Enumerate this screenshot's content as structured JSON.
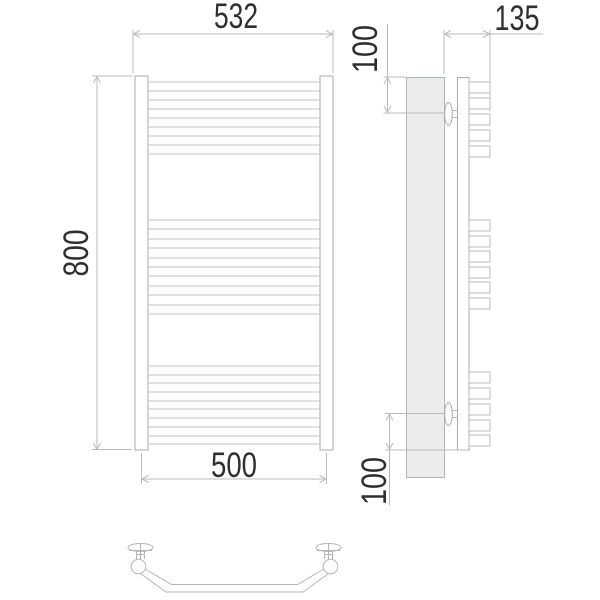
{
  "drawing": {
    "front_view": {
      "overall_width": "532",
      "overall_height": "800",
      "bottom_span": "500"
    },
    "side_view": {
      "depth": "135",
      "top_offset": "100",
      "bottom_offset": "100"
    },
    "colors": {
      "outline": "#b2b6b6",
      "dimension_line": "#b9bcbc",
      "wall_fill": "#ebecec",
      "label_text": "#2f2f2f"
    }
  }
}
